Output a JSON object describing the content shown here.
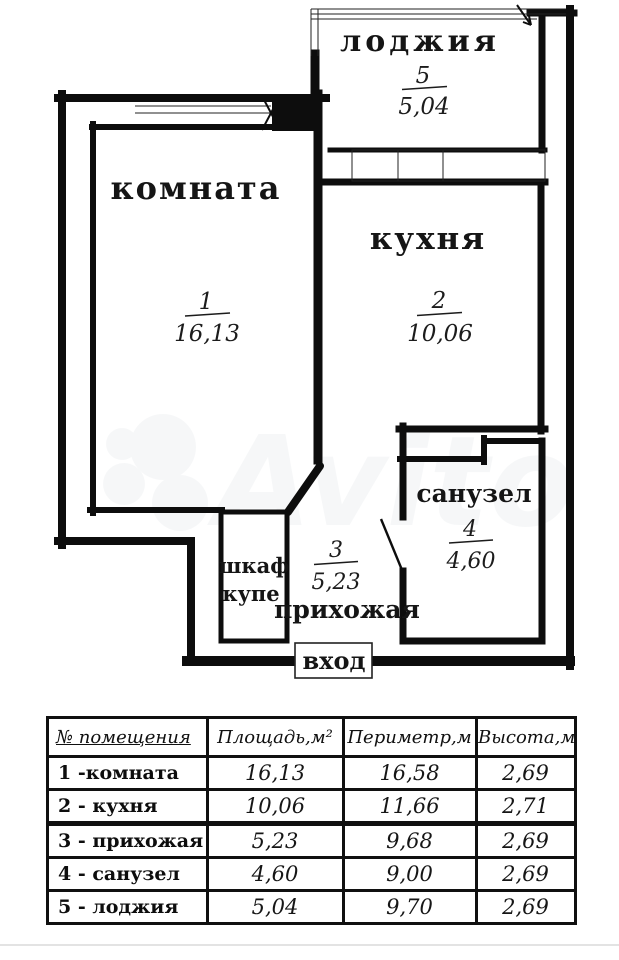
{
  "plan": {
    "rooms": [
      {
        "name": "лоджия",
        "number": "5",
        "area": "5,04"
      },
      {
        "name": "комната",
        "number": "1",
        "area": "16,13"
      },
      {
        "name": "кухня",
        "number": "2",
        "area": "10,06"
      },
      {
        "name": "прихожая",
        "number": "3",
        "area": "5,23"
      },
      {
        "name": "санузел",
        "number": "4",
        "area": "4,60"
      }
    ],
    "closet": {
      "line1": "шкаф",
      "line2": "купе"
    },
    "entrance_label": "вход",
    "watermark": "Avito",
    "wall_color": "#0d0d0d"
  },
  "table": {
    "headers": [
      "№ помещения",
      "Площадь,м²",
      "Периметр,м",
      "Высота,м"
    ],
    "rows": [
      {
        "name": "1 -комната",
        "area": "16,13",
        "perimeter": "16,58",
        "height": "2,69"
      },
      {
        "name": "2 - кухня",
        "area": "10,06",
        "perimeter": "11,66",
        "height": "2,71"
      },
      {
        "name": "3 - прихожая",
        "area": "5,23",
        "perimeter": "9,68",
        "height": "2,69"
      },
      {
        "name": "4 - санузел",
        "area": "4,60",
        "perimeter": "9,00",
        "height": "2,69"
      },
      {
        "name": "5 - лоджия",
        "area": "5,04",
        "perimeter": "9,70",
        "height": "2,69"
      }
    ]
  }
}
